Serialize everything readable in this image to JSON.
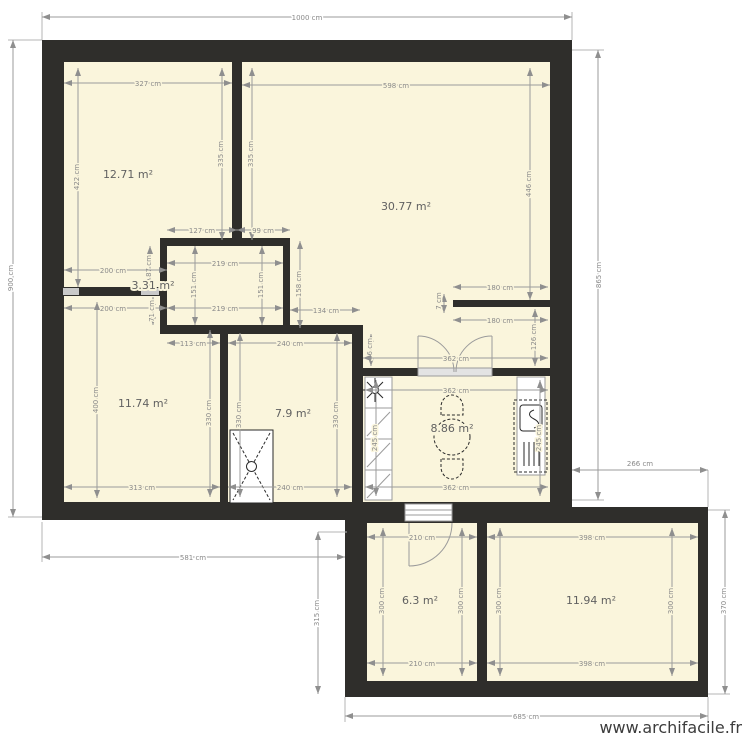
{
  "watermark": "www.archifacile.fr",
  "colors": {
    "wall": "#2f2e2b",
    "floor": "#faf5dc",
    "dimension": "#8a8a8a",
    "opening": "#c9c9c9"
  },
  "rooms": {
    "r1": "12.71 m²",
    "r2": "30.77 m²",
    "r3": "3.31 m²",
    "r4": "11.74 m²",
    "r5": "7.9 m²",
    "r6": "8.86 m²",
    "r7": "6.3 m²",
    "r8": "11.94 m²"
  },
  "dims": {
    "overall_width": "1000 cm",
    "overall_left": "900 cm",
    "overall_right": "865 cm",
    "upper_bottom": "581 cm",
    "lower_bottom": "685 cm",
    "lower_left": "315 cm",
    "lower_right": "370 cm",
    "right_offset": "266 cm",
    "r1_top": "327 cm",
    "r1_left": "422 cm",
    "r1_right": "335 cm",
    "r2_left": "335 cm",
    "r2_top": "598 cm",
    "r2_right": "446 cm",
    "hall_seg_a": "127 cm",
    "hall_seg_b": "99 cm",
    "hall_notch": "87 cm",
    "hall_pass_a": "200 cm",
    "hall_pass_b": "200 cm",
    "hall_gap": "71 cm",
    "hall_side": "158 cm",
    "hall_corridor": "134 cm",
    "hall_wall": "113 cm",
    "hall_kitchen_gap": "36 cm",
    "r3_top": "219 cm",
    "r3_bottom": "219 cm",
    "r3_left": "151 cm",
    "r3_right": "151 cm",
    "r4_left": "400 cm",
    "r4_right": "330 cm",
    "r4_bottom": "313 cm",
    "r5_top": "240 cm",
    "r5_bottom": "240 cm",
    "r5_left": "330 cm",
    "r5_right": "330 cm",
    "r6_hall": "362 cm",
    "r6_top": "362 cm",
    "r6_bottom": "362 cm",
    "r6_left": "245 cm",
    "r6_right": "245 cm",
    "r6_stub_top": "180 cm",
    "r6_stub_bottom": "180 cm",
    "r6_stub_thickness": "7 cm",
    "r6_nook": "126 cm",
    "r7_top": "210 cm",
    "r7_bottom": "210 cm",
    "r7_left": "300 cm",
    "r7_right": "300 cm",
    "r8_top": "398 cm",
    "r8_bottom": "398 cm",
    "r8_left": "300 cm",
    "r8_right": "300 cm"
  },
  "fixtures": {
    "shower": "shower-tray",
    "dining": "round-table-with-chairs",
    "kitchen_left": "kitchen-counter",
    "kitchen_right": "kitchen-sink-unit",
    "door_double": "double-swing-door",
    "door_single": "single-swing-door",
    "window": "window"
  }
}
